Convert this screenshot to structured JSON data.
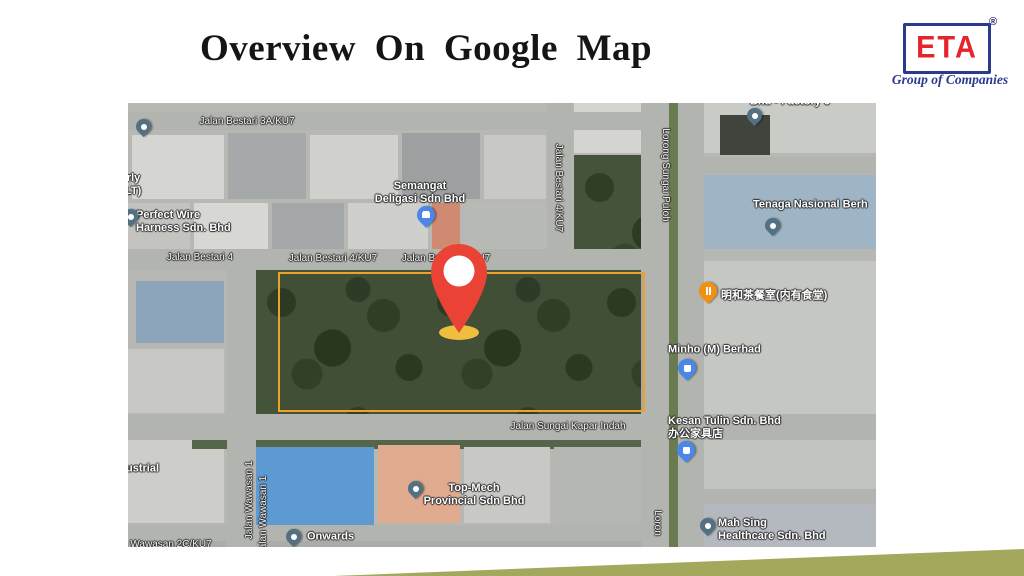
{
  "slide": {
    "title": "Overview On  Google Map"
  },
  "logo": {
    "brand": "ETA",
    "registered": "®",
    "tagline": "Group of Companies"
  },
  "colors": {
    "site_boundary": "#F0A12C",
    "pin": "#EA4335",
    "pin_shadow": "#EFBE3F",
    "logo_red": "#E4252B",
    "logo_blue": "#2B3990",
    "accent_olive": "#A3A85C"
  },
  "map": {
    "site_boundary": {
      "x": 150,
      "y": 169,
      "w": 363,
      "h": 136
    },
    "site_pin": {
      "cx": 331,
      "top": 139,
      "tip_y": 229
    },
    "labels": [
      {
        "kind": "road",
        "text": "Jalan Bestari 3A/KU7",
        "x": 119,
        "y": 19,
        "anchor": "center",
        "name": "road-label-jalan-bestari-3a-ku7"
      },
      {
        "kind": "road",
        "text": "Jalan Bestari 4",
        "x": 72,
        "y": 155,
        "anchor": "center",
        "name": "road-label-jalan-bestari-4"
      },
      {
        "kind": "road",
        "text": "Jalan Bestari 4/KU7",
        "x": 205,
        "y": 156,
        "anchor": "center",
        "name": "road-label-jalan-bestari-4-ku7-a"
      },
      {
        "kind": "road",
        "text": "Jalan Bestari 4/KU7",
        "x": 318,
        "y": 156,
        "anchor": "center",
        "name": "road-label-jalan-bestari-4-ku7-b"
      },
      {
        "kind": "road",
        "text": "Jalan Bestari 4/KU7",
        "x": 430,
        "y": 85,
        "anchor": "center",
        "rot": 90,
        "name": "road-label-jalan-bestari-4-ku7-vertical"
      },
      {
        "kind": "road",
        "text": "Lorong Sungai Puloh",
        "x": 537,
        "y": 72,
        "anchor": "center",
        "rot": 90,
        "name": "road-label-lorong-sungai-puloh"
      },
      {
        "kind": "road",
        "text": "Jalan Sungai Kapar Indah",
        "x": 440,
        "y": 324,
        "anchor": "center",
        "name": "road-label-jalan-sungai-kapar-indah"
      },
      {
        "kind": "road",
        "text": "Jalan Wawasan 1",
        "x": 122,
        "y": 397,
        "anchor": "center",
        "rot": -90,
        "name": "road-label-jalan-wawasan-1-a"
      },
      {
        "kind": "road",
        "text": "Jalan Wawasan 1",
        "x": 136,
        "y": 412,
        "anchor": "center",
        "rot": -90,
        "name": "road-label-jalan-wawasan-1-b"
      },
      {
        "kind": "road",
        "text": "n Wawasan 2C/KU7",
        "x": -6,
        "y": 442,
        "anchor": "left",
        "name": "road-label-wawasan-2c-ku7-partial"
      },
      {
        "kind": "road",
        "text": "Loron",
        "x": 529,
        "y": 420,
        "anchor": "center",
        "rot": 90,
        "name": "road-label-lorong-partial"
      },
      {
        "kind": "place",
        "text": "nerly\n(PLT)",
        "x": -14,
        "y": 82,
        "anchor": "left",
        "name": "place-label-plt-partial"
      },
      {
        "kind": "place",
        "text": "Perfect Wire\nHarness Sdn. Bhd",
        "x": 8,
        "y": 119,
        "anchor": "left",
        "name": "place-label-perfect-wire-harness"
      },
      {
        "kind": "place",
        "text": "Semangat\nDeligasi Sdn Bhd",
        "x": 292,
        "y": 90,
        "anchor": "center",
        "name": "place-label-semangat-deligasi"
      },
      {
        "kind": "place",
        "text": "Bhd - Factory 6",
        "x": 662,
        "y": -1,
        "anchor": "center",
        "name": "place-label-factory-partial"
      },
      {
        "kind": "place",
        "text": "Tenaga Nasional Berh",
        "x": 625,
        "y": 102,
        "anchor": "left",
        "name": "place-label-tenaga-nasional"
      },
      {
        "kind": "place",
        "text": "明和茶餐室(内有食堂)",
        "x": 593,
        "y": 193,
        "anchor": "left",
        "name": "place-label-minghe-restaurant"
      },
      {
        "kind": "place",
        "text": "Minho (M) Berhad",
        "x": 540,
        "y": 247,
        "anchor": "left",
        "name": "place-label-minho-berhad"
      },
      {
        "kind": "place",
        "text": "Kesan Tulin Sdn. Bhd\n办公家具店",
        "x": 540,
        "y": 325,
        "anchor": "left",
        "name": "place-label-kesan-tulin"
      },
      {
        "kind": "place",
        "text": "Top-Mech\nProvincial Sdn Bhd",
        "x": 346,
        "y": 392,
        "anchor": "center",
        "name": "place-label-top-mech-provincial"
      },
      {
        "kind": "place",
        "text": "Onwards",
        "x": 179,
        "y": 434,
        "anchor": "left",
        "name": "place-label-onwards"
      },
      {
        "kind": "place",
        "text": "Mah Sing\nHealthcare Sdn. Bhd",
        "x": 590,
        "y": 427,
        "anchor": "left",
        "name": "place-label-mah-sing-healthcare"
      },
      {
        "kind": "place",
        "text": "ustrial",
        "x": -2,
        "y": 366,
        "anchor": "left",
        "name": "place-label-industrial-partial"
      }
    ],
    "markers": [
      {
        "x": 15,
        "y": 25,
        "icon": "place-dot",
        "variant": "slate",
        "size": 15,
        "name": "marker-plt"
      },
      {
        "x": 2,
        "y": 115,
        "icon": "place-dot",
        "variant": "slate",
        "size": 15,
        "name": "marker-perfect-wire"
      },
      {
        "x": 298,
        "y": 114,
        "icon": "briefcase",
        "variant": "blue",
        "size": 18,
        "name": "marker-semangat-deligasi"
      },
      {
        "x": 626,
        "y": 14,
        "icon": "place-dot",
        "variant": "slate",
        "size": 15,
        "name": "marker-factory"
      },
      {
        "x": 644,
        "y": 124,
        "icon": "place-dot",
        "variant": "slate",
        "size": 15,
        "name": "marker-tenaga-nasional"
      },
      {
        "x": 580,
        "y": 190,
        "icon": "restaurant",
        "variant": "orange",
        "size": 18,
        "name": "marker-minghe-restaurant"
      },
      {
        "x": 559,
        "y": 267,
        "icon": "shopping-bag",
        "variant": "blue",
        "size": 18,
        "name": "marker-minho-berhad"
      },
      {
        "x": 558,
        "y": 349,
        "icon": "shopping-bag",
        "variant": "blue",
        "size": 18,
        "name": "marker-kesan-tulin"
      },
      {
        "x": 287,
        "y": 387,
        "icon": "place-dot",
        "variant": "slate",
        "size": 15,
        "name": "marker-top-mech"
      },
      {
        "x": 165,
        "y": 435,
        "icon": "place-dot",
        "variant": "slate",
        "size": 15,
        "name": "marker-onwards"
      },
      {
        "x": 579,
        "y": 424,
        "icon": "place-dot",
        "variant": "slate",
        "size": 15,
        "name": "marker-mah-sing"
      }
    ]
  }
}
